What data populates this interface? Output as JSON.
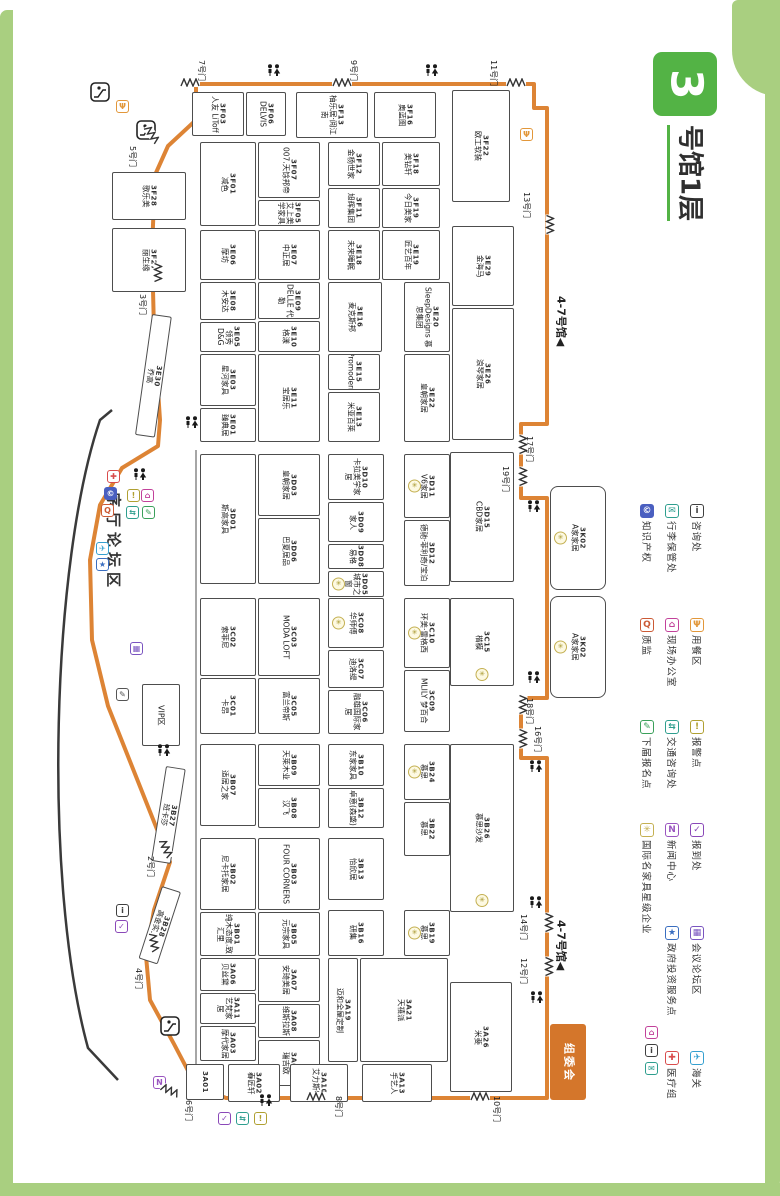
{
  "title": {
    "hall_number": "3",
    "hall_label": "号馆1层"
  },
  "colors": {
    "frame": "#a9cf80",
    "title_green": "#53b345",
    "route_orange": "#dd8435",
    "committee_orange": "#d4762b",
    "booth_border": "#4d4d4d",
    "star_yellow": "#c4b052"
  },
  "map": {
    "booths": [
      {
        "c": "3F03",
        "n": "人友 LiToff",
        "x": 192,
        "y": 92,
        "w": 52,
        "h": 44
      },
      {
        "c": "3F06",
        "n": "DELVIS",
        "x": 246,
        "y": 92,
        "w": 40,
        "h": 44
      },
      {
        "c": "3F13",
        "n": "柚乐居·阅江南",
        "x": 296,
        "y": 92,
        "w": 72,
        "h": 46
      },
      {
        "c": "3F16",
        "n": "奥蓝图",
        "x": 374,
        "y": 92,
        "w": 62,
        "h": 46
      },
      {
        "c": "3F22",
        "n": "欧工软装",
        "x": 452,
        "y": 90,
        "w": 58,
        "h": 112
      },
      {
        "c": "3F28",
        "n": "歌乐美",
        "x": 112,
        "y": 172,
        "w": 74,
        "h": 48
      },
      {
        "c": "3F27",
        "n": "丽生缘",
        "x": 112,
        "y": 228,
        "w": 74,
        "h": 64
      },
      {
        "c": "3F01",
        "n": "减色",
        "x": 200,
        "y": 142,
        "w": 56,
        "h": 84
      },
      {
        "c": "3F07",
        "n": "007.天馀邦帝",
        "x": 258,
        "y": 142,
        "w": 62,
        "h": 56
      },
      {
        "c": "3F05",
        "n": "艾上美学家具",
        "x": 258,
        "y": 200,
        "w": 62,
        "h": 26
      },
      {
        "c": "3F12",
        "n": "金杨世家",
        "x": 328,
        "y": 142,
        "w": 52,
        "h": 44
      },
      {
        "c": "3F11",
        "n": "旭辉集团",
        "x": 328,
        "y": 188,
        "w": 52,
        "h": 40
      },
      {
        "c": "3F18",
        "n": "美钻轩",
        "x": 382,
        "y": 142,
        "w": 58,
        "h": 44
      },
      {
        "c": "3F19",
        "n": "今日美家",
        "x": 382,
        "y": 188,
        "w": 58,
        "h": 40
      },
      {
        "c": "3E06",
        "n": "摩坊",
        "x": 200,
        "y": 230,
        "w": 56,
        "h": 50
      },
      {
        "c": "3E07",
        "n": "中正居",
        "x": 258,
        "y": 230,
        "w": 62,
        "h": 50
      },
      {
        "c": "3E18",
        "n": "未来睡眠",
        "x": 328,
        "y": 230,
        "w": 52,
        "h": 50
      },
      {
        "c": "3E19",
        "n": "匠艺百年",
        "x": 382,
        "y": 230,
        "w": 58,
        "h": 50
      },
      {
        "c": "3E29",
        "n": "金海马",
        "x": 452,
        "y": 226,
        "w": 62,
        "h": 80
      },
      {
        "c": "3E08",
        "n": "木安达",
        "x": 200,
        "y": 282,
        "w": 56,
        "h": 38
      },
      {
        "c": "3E05",
        "n": "领秀D&G",
        "x": 200,
        "y": 322,
        "w": 56,
        "h": 30
      },
      {
        "c": "3E09",
        "n": "DELLE 代勒",
        "x": 258,
        "y": 282,
        "w": 62,
        "h": 37
      },
      {
        "c": "3E10",
        "n": "格漾",
        "x": 258,
        "y": 321,
        "w": 62,
        "h": 31
      },
      {
        "c": "3E16",
        "n": "麦克斯邦",
        "x": 328,
        "y": 282,
        "w": 54,
        "h": 70
      },
      {
        "c": "3E20",
        "n": "SleepDesigns 慕思集团",
        "x": 404,
        "y": 282,
        "w": 46,
        "h": 70
      },
      {
        "c": "3E26",
        "n": "浪琴家居",
        "x": 452,
        "y": 308,
        "w": 62,
        "h": 132
      },
      {
        "c": "3E03",
        "n": "星河家具",
        "x": 200,
        "y": 354,
        "w": 56,
        "h": 52
      },
      {
        "c": "3E01",
        "n": "臻典居",
        "x": 200,
        "y": 408,
        "w": 56,
        "h": 34
      },
      {
        "c": "3E11",
        "n": "宝居乐",
        "x": 258,
        "y": 354,
        "w": 62,
        "h": 88
      },
      {
        "c": "3E15",
        "n": "Promodern",
        "x": 328,
        "y": 354,
        "w": 52,
        "h": 36
      },
      {
        "c": "3E13",
        "n": "米亚百莱",
        "x": 328,
        "y": 392,
        "w": 52,
        "h": 50
      },
      {
        "c": "3E22",
        "n": "皇朝家居",
        "x": 404,
        "y": 354,
        "w": 46,
        "h": 88
      },
      {
        "c": "3D01",
        "n": "斯高家具",
        "x": 200,
        "y": 454,
        "w": 56,
        "h": 130
      },
      {
        "c": "3D03",
        "n": "皇朝家居",
        "x": 258,
        "y": 454,
        "w": 62,
        "h": 62
      },
      {
        "c": "3D06",
        "n": "巴夏居品",
        "x": 258,
        "y": 518,
        "w": 62,
        "h": 66
      },
      {
        "c": "3D10",
        "n": "卡拉美学家居",
        "x": 328,
        "y": 454,
        "w": 56,
        "h": 46
      },
      {
        "c": "3D09",
        "n": "家人",
        "x": 328,
        "y": 502,
        "w": 56,
        "h": 40
      },
      {
        "c": "3D08",
        "n": "易格",
        "x": 328,
        "y": 544,
        "w": 56,
        "h": 25
      },
      {
        "c": "3D05",
        "n": "城市之窗",
        "x": 328,
        "y": 571,
        "w": 56,
        "h": 26,
        "s": 1
      },
      {
        "c": "3D11",
        "n": "V6家居",
        "x": 404,
        "y": 454,
        "w": 46,
        "h": 64,
        "s": 1
      },
      {
        "c": "3D12",
        "n": "德驰·菲利奇/宝泊",
        "x": 404,
        "y": 520,
        "w": 46,
        "h": 66
      },
      {
        "c": "3D15",
        "n": "CBD家居",
        "x": 450,
        "y": 452,
        "w": 64,
        "h": 130
      },
      {
        "c": "3C02",
        "n": "索菲尼",
        "x": 200,
        "y": 598,
        "w": 56,
        "h": 78
      },
      {
        "c": "3C03",
        "n": "MODA LOFT",
        "x": 258,
        "y": 598,
        "w": 62,
        "h": 78
      },
      {
        "c": "3C01",
        "n": "卡昂",
        "x": 200,
        "y": 678,
        "w": 56,
        "h": 56
      },
      {
        "c": "3C05",
        "n": "富兰帝斯",
        "x": 258,
        "y": 678,
        "w": 62,
        "h": 56
      },
      {
        "c": "3C08",
        "n": "华师傅",
        "x": 328,
        "y": 598,
        "w": 56,
        "h": 50,
        "s": 1
      },
      {
        "c": "3C07",
        "n": "迪洛缇",
        "x": 328,
        "y": 650,
        "w": 56,
        "h": 38
      },
      {
        "c": "3C06",
        "n": "融雄国际家居",
        "x": 328,
        "y": 690,
        "w": 56,
        "h": 44
      },
      {
        "c": "3C10",
        "n": "环美·雷格西",
        "x": 404,
        "y": 598,
        "w": 46,
        "h": 70,
        "s": 1
      },
      {
        "c": "3C09",
        "n": "MLILY 梦百合",
        "x": 404,
        "y": 670,
        "w": 46,
        "h": 62
      },
      {
        "c": "3C15",
        "n": "楷模",
        "x": 450,
        "y": 598,
        "w": 64,
        "h": 88,
        "s": 1
      },
      {
        "c": "3B07",
        "n": "适居之家",
        "x": 200,
        "y": 744,
        "w": 56,
        "h": 82
      },
      {
        "c": "3B09",
        "n": "天莱木业",
        "x": 258,
        "y": 744,
        "w": 62,
        "h": 42
      },
      {
        "c": "3B08",
        "n": "汉飞",
        "x": 258,
        "y": 788,
        "w": 62,
        "h": 40
      },
      {
        "c": "3B10",
        "n": "东家家具",
        "x": 328,
        "y": 744,
        "w": 56,
        "h": 42
      },
      {
        "c": "3B12",
        "n": "卓意(森盛)",
        "x": 328,
        "y": 788,
        "w": 56,
        "h": 40
      },
      {
        "c": "3B24",
        "n": "慕思",
        "x": 404,
        "y": 744,
        "w": 46,
        "h": 56,
        "s": 1
      },
      {
        "c": "3B22",
        "n": "慕思",
        "x": 404,
        "y": 802,
        "w": 46,
        "h": 54
      },
      {
        "c": "3B26",
        "n": "慕思沙发",
        "x": 450,
        "y": 744,
        "w": 64,
        "h": 168,
        "s": 1
      },
      {
        "c": "3B02",
        "n": "尼卡托家居",
        "x": 200,
        "y": 838,
        "w": 56,
        "h": 72
      },
      {
        "c": "3B03",
        "n": "FOUR CORNERS",
        "x": 258,
        "y": 838,
        "w": 62,
        "h": 72
      },
      {
        "c": "3B13",
        "n": "怡欣居",
        "x": 328,
        "y": 838,
        "w": 56,
        "h": 62
      },
      {
        "c": "3B01",
        "n": "纯木态度.致汇里",
        "x": 200,
        "y": 912,
        "w": 56,
        "h": 44
      },
      {
        "c": "3B05",
        "n": "元宗家具",
        "x": 258,
        "y": 912,
        "w": 62,
        "h": 44
      },
      {
        "c": "3B16",
        "n": "研集",
        "x": 328,
        "y": 910,
        "w": 56,
        "h": 46
      },
      {
        "c": "3B19",
        "n": "慕思",
        "x": 404,
        "y": 910,
        "w": 46,
        "h": 46,
        "s": 1
      },
      {
        "c": "3A06",
        "n": "贝丝黛",
        "x": 200,
        "y": 958,
        "w": 56,
        "h": 33
      },
      {
        "c": "3A11",
        "n": "艺梵家居",
        "x": 200,
        "y": 993,
        "w": 56,
        "h": 31
      },
      {
        "c": "3A03",
        "n": "摩代家居",
        "x": 200,
        "y": 1026,
        "w": 56,
        "h": 35
      },
      {
        "c": "3A07",
        "n": "安琦美居",
        "x": 258,
        "y": 958,
        "w": 62,
        "h": 44
      },
      {
        "c": "3A08",
        "n": "维斯拉斯",
        "x": 258,
        "y": 1004,
        "w": 62,
        "h": 34
      },
      {
        "c": "3A09",
        "n": "瑞吉欧",
        "x": 258,
        "y": 1040,
        "w": 62,
        "h": 46
      },
      {
        "c": "3A19",
        "n": "迈和全屋定制",
        "x": 328,
        "y": 958,
        "w": 30,
        "h": 104
      },
      {
        "c": "3A21",
        "n": "天禧派",
        "x": 360,
        "y": 958,
        "w": 88,
        "h": 104
      },
      {
        "c": "3A26",
        "n": "米斐",
        "x": 450,
        "y": 982,
        "w": 62,
        "h": 110
      },
      {
        "c": "3A01",
        "n": "",
        "x": 186,
        "y": 1064,
        "w": 38,
        "h": 36
      },
      {
        "c": "3A02",
        "n": "春匠轩",
        "x": 228,
        "y": 1064,
        "w": 52,
        "h": 38
      },
      {
        "c": "3A10",
        "n": "艾力斯特",
        "x": 290,
        "y": 1064,
        "w": 58,
        "h": 38
      },
      {
        "c": "3A13",
        "n": "手艺人",
        "x": 362,
        "y": 1064,
        "w": 70,
        "h": 38
      },
      {
        "c": "3K02",
        "n": "A家家居",
        "x": 550,
        "y": 486,
        "w": 56,
        "h": 104,
        "s": 1
      },
      {
        "c": "3K02",
        "n": "A家家居",
        "x": 550,
        "y": 596,
        "w": 56,
        "h": 102,
        "s": 1
      },
      {
        "c": "3E30",
        "n": "乔高",
        "x": 152,
        "y": 314,
        "w": 20,
        "h": 122,
        "r": 8
      },
      {
        "c": "3B27",
        "n": "班卡莎",
        "x": 166,
        "y": 766,
        "w": 20,
        "h": 96,
        "r": 9
      },
      {
        "c": "3B28",
        "n": "高金实业",
        "x": 162,
        "y": 886,
        "w": 20,
        "h": 76,
        "r": 18
      }
    ],
    "gates": [
      {
        "l": "7号门",
        "lx": 197,
        "ly": 60,
        "zx": 180,
        "zy": 78,
        "zr": 0
      },
      {
        "l": "9号门",
        "lx": 349,
        "ly": 60,
        "zx": 332,
        "zy": 78,
        "zr": 0
      },
      {
        "l": "11号门",
        "lx": 489,
        "ly": 60,
        "zx": 506,
        "zy": 78,
        "zr": 0
      },
      {
        "l": "13号门",
        "lx": 522,
        "ly": 192,
        "zx": 540,
        "zy": 220,
        "zr": 90
      },
      {
        "l": "17号门",
        "lx": 525,
        "ly": 436,
        "zx": 513,
        "zy": 440,
        "zr": 90
      },
      {
        "l": "19号门",
        "lx": 501,
        "ly": 466,
        "zx": 513,
        "zy": 472,
        "zr": 90
      },
      {
        "l": "18号门",
        "lx": 525,
        "ly": 698,
        "zx": 513,
        "zy": 700,
        "zr": 90
      },
      {
        "l": "16号门",
        "lx": 533,
        "ly": 726,
        "zx": 513,
        "zy": 734,
        "zr": 90
      },
      {
        "l": "14号门",
        "lx": 519,
        "ly": 914,
        "zx": 539,
        "zy": 918,
        "zr": 90
      },
      {
        "l": "12号门",
        "lx": 519,
        "ly": 958,
        "zx": 539,
        "zy": 962,
        "zr": 90
      },
      {
        "l": "10号门",
        "lx": 492,
        "ly": 1096,
        "zx": 470,
        "zy": 1092,
        "zr": 0
      },
      {
        "l": "8号门",
        "lx": 334,
        "ly": 1096,
        "zx": 306,
        "zy": 1092,
        "zr": 0
      },
      {
        "l": "6号门",
        "lx": 184,
        "ly": 1100,
        "zx": 160,
        "zy": 1086,
        "zr": 25
      },
      {
        "l": "2号门",
        "lx": 146,
        "ly": 856,
        "zx": 156,
        "zy": 844,
        "zr": 65
      },
      {
        "l": "4号门",
        "lx": 134,
        "ly": 968,
        "zx": 144,
        "zy": 938,
        "zr": 80
      },
      {
        "l": "5号门",
        "lx": 128,
        "ly": 146,
        "zx": 142,
        "zy": 130,
        "zr": 55
      },
      {
        "l": "3号门",
        "lx": 138,
        "ly": 294,
        "zx": 148,
        "zy": 268,
        "zr": 90
      }
    ],
    "icons": [
      {
        "t": "dining",
        "x": 116,
        "y": 100
      },
      {
        "t": "dining",
        "x": 520,
        "y": 128
      },
      {
        "t": "wc",
        "x": 266,
        "y": 64
      },
      {
        "t": "wc",
        "x": 424,
        "y": 64
      },
      {
        "t": "wc",
        "x": 132,
        "y": 468
      },
      {
        "t": "wc",
        "x": 184,
        "y": 416
      },
      {
        "t": "wc",
        "x": 156,
        "y": 744
      },
      {
        "t": "wc",
        "x": 526,
        "y": 500
      },
      {
        "t": "wc",
        "x": 526,
        "y": 671
      },
      {
        "t": "wc",
        "x": 528,
        "y": 760
      },
      {
        "t": "wc",
        "x": 528,
        "y": 896
      },
      {
        "t": "wc",
        "x": 529,
        "y": 991
      },
      {
        "t": "wc",
        "x": 258,
        "y": 1094
      },
      {
        "t": "esc",
        "x": 90,
        "y": 82
      },
      {
        "t": "esc",
        "x": 136,
        "y": 120
      },
      {
        "t": "esc",
        "x": 160,
        "y": 1016
      },
      {
        "t": "medical",
        "x": 107,
        "y": 470
      },
      {
        "t": "ip",
        "x": 104,
        "y": 487
      },
      {
        "t": "magnifier",
        "x": 101,
        "y": 504
      },
      {
        "t": "police",
        "x": 127,
        "y": 489
      },
      {
        "t": "office",
        "x": 141,
        "y": 489
      },
      {
        "t": "traffic",
        "x": 126,
        "y": 506
      },
      {
        "t": "nextreg",
        "x": 142,
        "y": 506
      },
      {
        "t": "customs",
        "x": 96,
        "y": 542
      },
      {
        "t": "gov",
        "x": 96,
        "y": 558
      },
      {
        "t": "forum",
        "x": 130,
        "y": 642
      },
      {
        "t": "pen",
        "x": 116,
        "y": 688
      },
      {
        "t": "info",
        "x": 116,
        "y": 904
      },
      {
        "t": "checkin",
        "x": 115,
        "y": 920
      },
      {
        "t": "news",
        "x": 153,
        "y": 1076
      },
      {
        "t": "checkin",
        "x": 218,
        "y": 1112
      },
      {
        "t": "traffic",
        "x": 236,
        "y": 1112
      },
      {
        "t": "police",
        "x": 254,
        "y": 1112
      },
      {
        "t": "office",
        "x": 645,
        "y": 1026
      },
      {
        "t": "info",
        "x": 645,
        "y": 1044
      },
      {
        "t": "luggage",
        "x": 645,
        "y": 1062
      }
    ],
    "areas": {
      "lobby_forum": {
        "label": "序厅论坛区",
        "x": 104,
        "y": 492
      },
      "vip": {
        "label": "VIP区",
        "x": 142,
        "y": 684,
        "w": 38,
        "h": 62
      },
      "committee": {
        "label": "组委会",
        "x": 550,
        "y": 1024,
        "w": 36,
        "h": 76
      },
      "hall47_label": "4-7号馆",
      "hall47_arrow": "◀",
      "hall47_positions": [
        {
          "x": 554,
          "y": 296
        },
        {
          "x": 554,
          "y": 920
        }
      ]
    }
  },
  "legend": {
    "items": [
      {
        "label": "咨询处",
        "icon": "info",
        "x": 690,
        "y": 504
      },
      {
        "label": "行李保管处",
        "icon": "luggage",
        "x": 665,
        "y": 504
      },
      {
        "label": "知识产权",
        "icon": "ip",
        "x": 640,
        "y": 504
      },
      {
        "label": "用餐区",
        "icon": "dining",
        "x": 690,
        "y": 618
      },
      {
        "label": "现场办公室",
        "icon": "office",
        "x": 665,
        "y": 618
      },
      {
        "label": "质监",
        "icon": "magnifier",
        "x": 640,
        "y": 618
      },
      {
        "label": "报警点",
        "icon": "police",
        "x": 690,
        "y": 720
      },
      {
        "label": "交通咨询处",
        "icon": "traffic",
        "x": 665,
        "y": 720
      },
      {
        "label": "下届报名点",
        "icon": "nextreg",
        "x": 640,
        "y": 720
      },
      {
        "label": "报到处",
        "icon": "checkin",
        "x": 690,
        "y": 823
      },
      {
        "label": "新闻中心",
        "icon": "news",
        "x": 665,
        "y": 823
      },
      {
        "label": "国际名家具星级企业",
        "icon": "starent",
        "x": 640,
        "y": 823
      },
      {
        "label": "会议论坛区",
        "icon": "forum",
        "x": 690,
        "y": 926
      },
      {
        "label": "政府投资服务点",
        "icon": "gov",
        "x": 665,
        "y": 926
      },
      {
        "label": "海关",
        "icon": "customs",
        "x": 690,
        "y": 1051
      },
      {
        "label": "医疗组",
        "icon": "medical",
        "x": 665,
        "y": 1051
      }
    ]
  },
  "icon_styles": {
    "info": {
      "glyph": "i",
      "color": "#3f3f3f"
    },
    "luggage": {
      "glyph": "✉",
      "color": "#2e9e8e"
    },
    "ip": {
      "glyph": "©",
      "color": "#4a5fc0",
      "fill": true
    },
    "dining": {
      "glyph": "Ψ",
      "color": "#e2973a"
    },
    "office": {
      "glyph": "⌂",
      "color": "#c2419a"
    },
    "magnifier": {
      "glyph": "Q",
      "color": "#cb5a35"
    },
    "police": {
      "glyph": "!",
      "color": "#b0a032"
    },
    "traffic": {
      "glyph": "⇆",
      "color": "#2e9e8e"
    },
    "nextreg": {
      "glyph": "✎",
      "color": "#3aa05a"
    },
    "checkin": {
      "glyph": "✓",
      "color": "#8a48b8"
    },
    "news": {
      "glyph": "N",
      "color": "#9a55c0"
    },
    "starent": {
      "glyph": "✳",
      "color": "#c4b052",
      "round": true
    },
    "forum": {
      "glyph": "▦",
      "color": "#7a55c0"
    },
    "gov": {
      "glyph": "★",
      "color": "#3a6ec0"
    },
    "customs": {
      "glyph": "✈",
      "color": "#35a0d0"
    },
    "medical": {
      "glyph": "✚",
      "color": "#d94c4c"
    },
    "pen": {
      "glyph": "✎",
      "color": "#555555"
    }
  }
}
